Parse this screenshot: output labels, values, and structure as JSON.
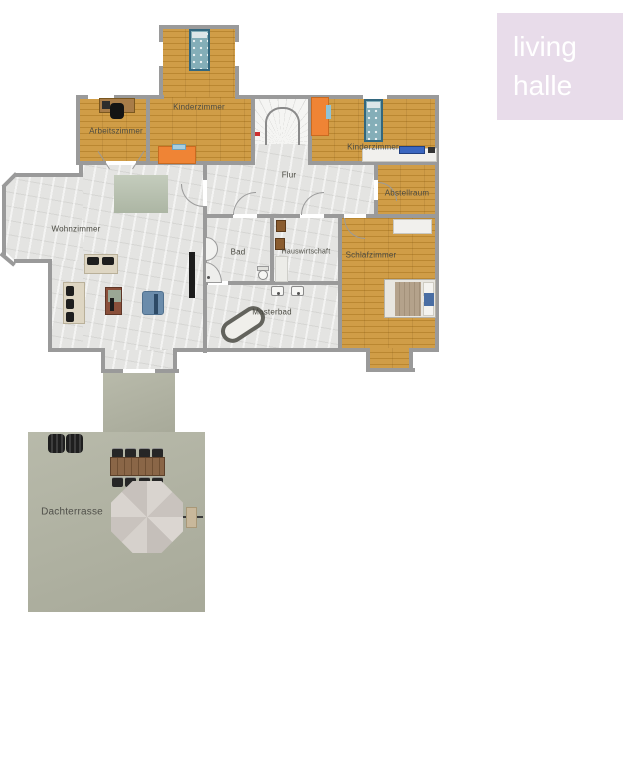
{
  "logo": {
    "line1": "living",
    "line2": "halle",
    "background": "#e8dcea",
    "text_color": "#ffffff"
  },
  "rooms": {
    "arbeitszimmer": {
      "label": "Arbeitszimmer"
    },
    "kinderzimmer_left": {
      "label": "Kinderzimmer"
    },
    "kinderzimmer_right": {
      "label": "Kinderzimmer"
    },
    "flur": {
      "label": "Flur"
    },
    "abstellraum": {
      "label": "Abstellraum"
    },
    "wohnzimmer": {
      "label": "Wohnzimmer"
    },
    "bad": {
      "label": "Bad"
    },
    "hauswirtschaft": {
      "label": "Hauswirtschaft"
    },
    "schlafzimmer": {
      "label": "Schlafzimmer"
    },
    "masterbad": {
      "label": "Masterbad"
    },
    "dachterrasse": {
      "label": "Dachterrasse"
    }
  },
  "colors": {
    "wood_floor": "#c9953e",
    "tile_floor": "#e4e4e2",
    "terrace_floor": "#b2b4a3",
    "wall": "#9a9a9a",
    "accent_orange": "#ef8435",
    "bed_teal": "#84aeb8",
    "label_text": "#4a4a42",
    "page_background": "#ffffff"
  }
}
